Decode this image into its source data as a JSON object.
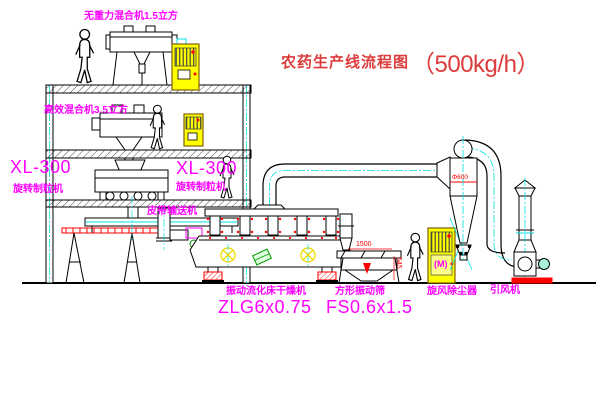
{
  "title": {
    "name": "农药生产线流程图",
    "capacity": "（500kg/h）"
  },
  "equipment_labels": {
    "top_mixer": "无重力混合机1.5立方",
    "mid_mixer": "高效混合机3.5立方",
    "granulator_left_model": "XL-300",
    "granulator_left_name": "旋转制粒机",
    "granulator_right_model": "XL-300",
    "granulator_right_name": "旋转制粒机",
    "belt_conveyor": "皮带输送机",
    "dryer_name": "振动流化床干燥机",
    "dryer_model": "ZLG6x0.75",
    "sieve_name": "方形振动筛",
    "sieve_model": "FS0.6x1.5",
    "cyclone_name": "旋风除尘器",
    "fan_name": "引风机"
  },
  "dimensions": {
    "sieve_length": "1500",
    "sieve_height": "545",
    "cyclone_diameter": "Φ600"
  },
  "control_cabinet": {
    "meter_symbol": "(M)"
  },
  "colors": {
    "label_magenta": "#ff00ff",
    "title_red": "#dd3c3c",
    "dimension_red": "#ff0000",
    "cabinet_yellow": "#ffff00",
    "centerline_cyan": "#00e0e0",
    "line_black": "#000000"
  }
}
